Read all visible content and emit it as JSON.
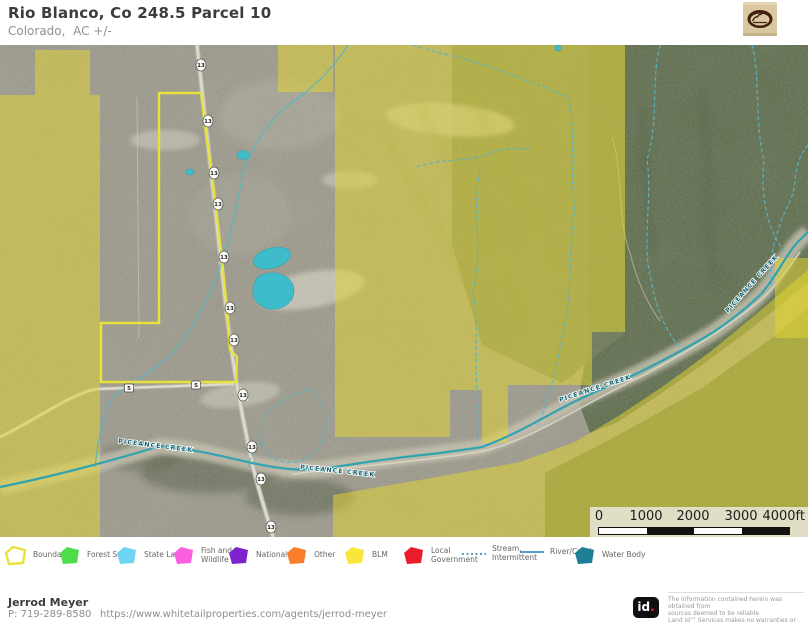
{
  "header": {
    "title": "Rio Blanco, Co 248.5 Parcel 10",
    "subtitle": "Colorado,  AC +/-"
  },
  "map": {
    "highway_shield": "13",
    "county_road_shield": "5",
    "creek_label": "PICEANCE CREEK",
    "boundary_color": "#e8e33a",
    "blm_fill": "#e3d52f",
    "water_color": "#2ea3b0",
    "lake_fill": "#3bbccb",
    "scale_bar": {
      "labels": [
        "0",
        "1000",
        "2000",
        "3000",
        "4000ft"
      ]
    }
  },
  "legend": {
    "items": [
      {
        "label": "Boundary",
        "swatch": "outline",
        "color": "#e8e33a"
      },
      {
        "label": "Forest Servic",
        "swatch": "fill",
        "color": "#4edd4b"
      },
      {
        "label": "State Land",
        "swatch": "fill",
        "color": "#6fd4f4"
      },
      {
        "label": "Fish and Wildlife",
        "swatch": "fill",
        "color": "#fa5fe0"
      },
      {
        "label": "National Park",
        "swatch": "fill",
        "color": "#7d22cc"
      },
      {
        "label": "Other",
        "swatch": "fill",
        "color": "#fa7f2a"
      },
      {
        "label": "BLM",
        "swatch": "fill",
        "color": "#f8e63d"
      },
      {
        "label": "Local Government",
        "swatch": "fill",
        "color": "#ea1c2c"
      },
      {
        "label": "Stream, Intermittent",
        "swatch": "dashed-line",
        "color": "#3f8fbe"
      },
      {
        "label": "River/Creek",
        "swatch": "line",
        "color": "#3f8fbe"
      },
      {
        "label": "Water Body",
        "swatch": "fill",
        "color": "#1e7e95"
      }
    ]
  },
  "footer": {
    "agent_name": "Jerrod Meyer",
    "phone": "P: 719-289-8580",
    "url": "https://www.whitetailproperties.com/agents/jerrod-meyer",
    "brand_id": "id",
    "brand_dot": ".",
    "disclaimer_lines": [
      "The information contained herein was obtained from",
      "sources deemed to be reliable.",
      " Land id™ Services makes no warranties or guarantees",
      "as to the completeness or accuracy thereof."
    ]
  }
}
